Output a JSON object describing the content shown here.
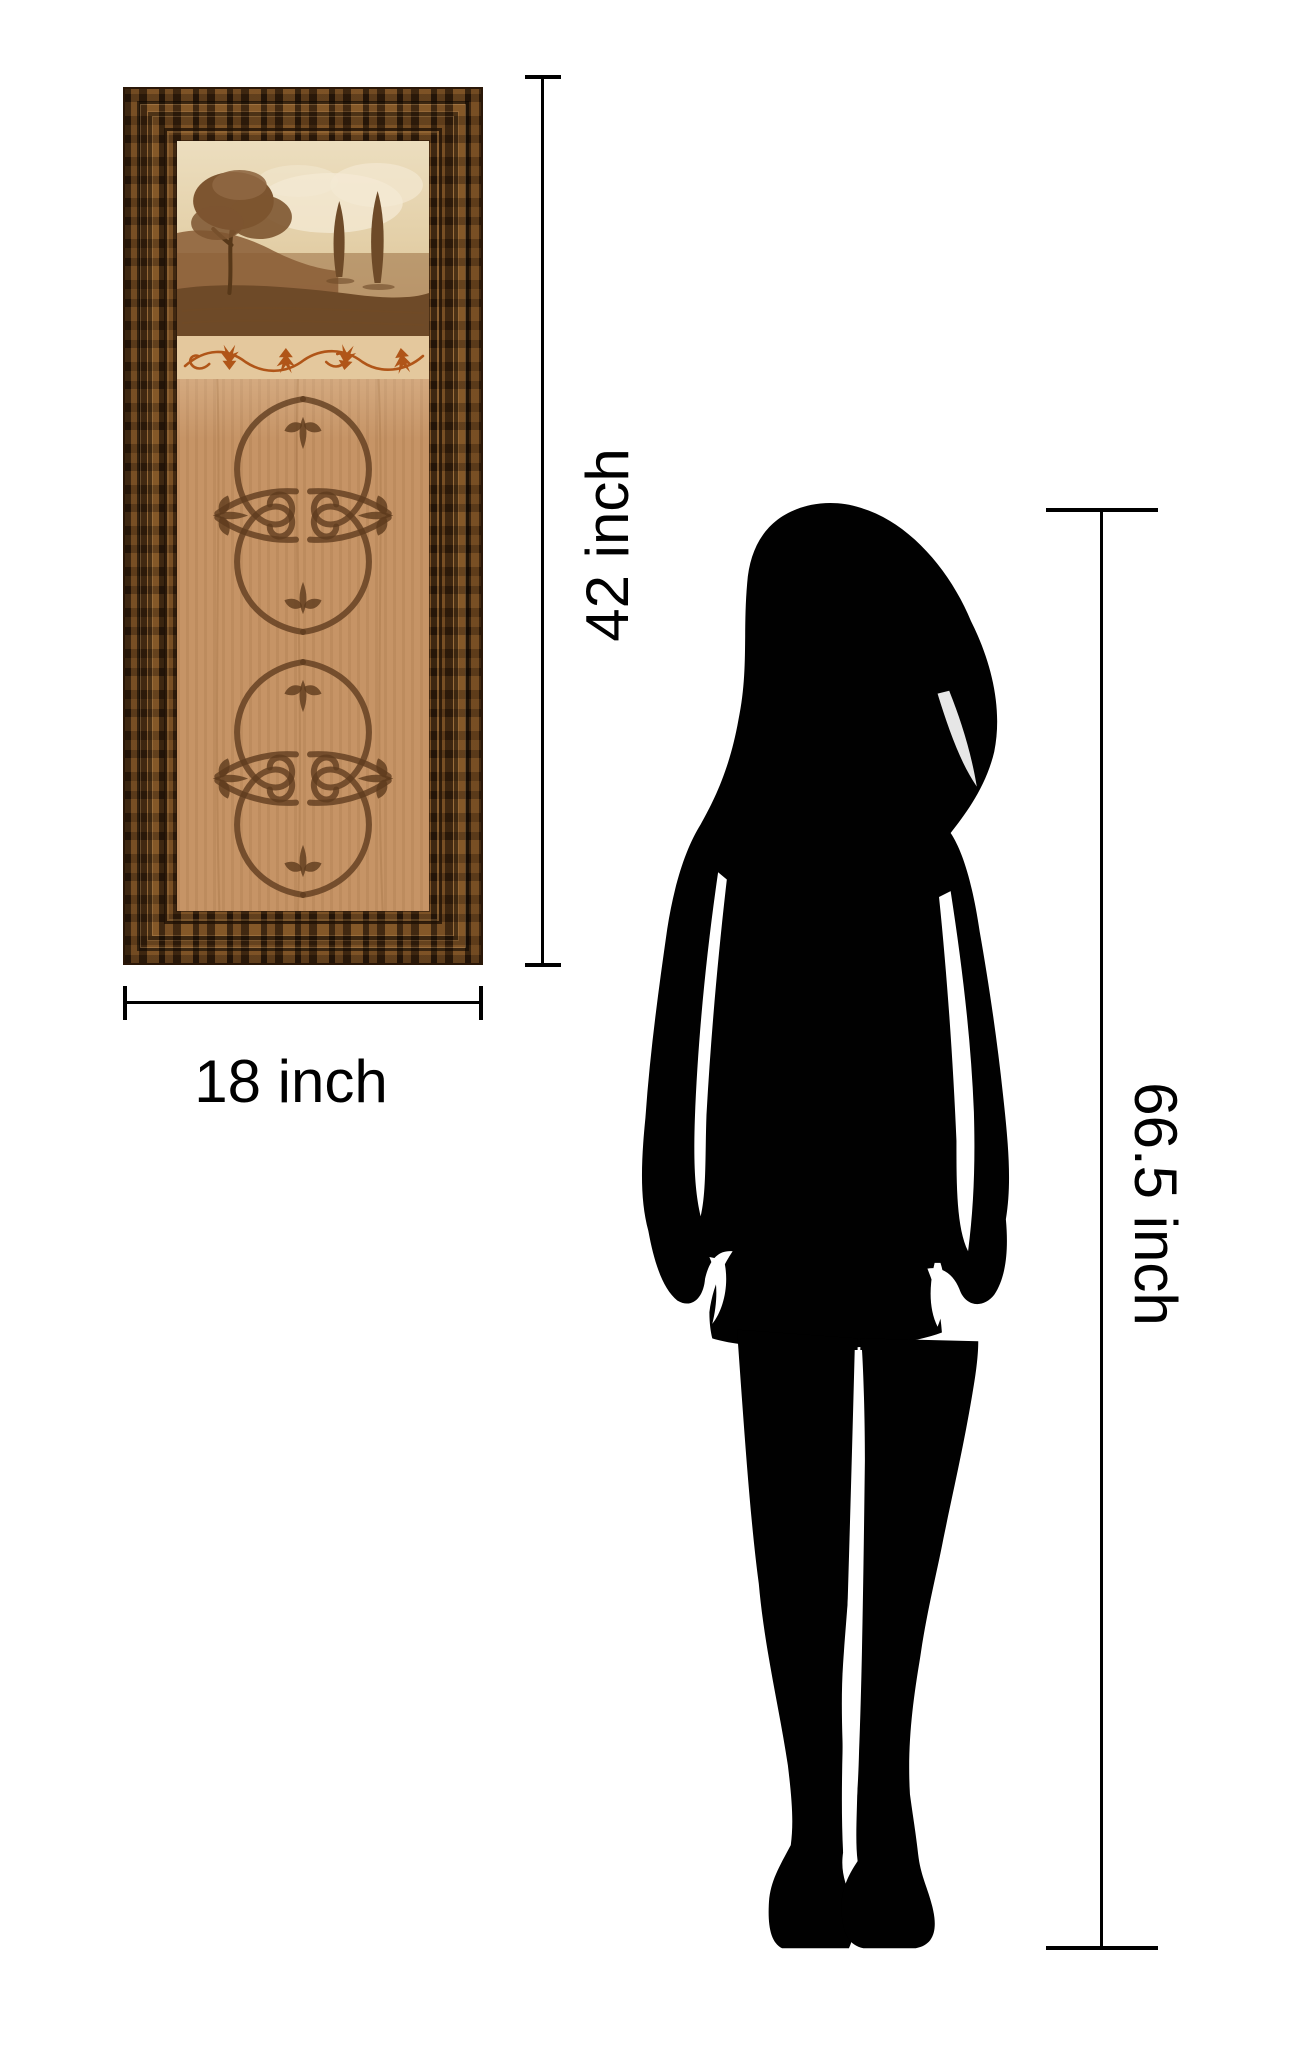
{
  "artwork": {
    "height_label": "42 inch",
    "width_label": "18 inch"
  },
  "person": {
    "height_label": "66.5 inch"
  },
  "colors": {
    "background": "#ffffff",
    "line": "#000000",
    "silhouette": "#010101",
    "frame_base": "#5d3c1c",
    "frame_dark": "#2a1708",
    "panel_wood": "#c69466",
    "band_bg": "#e4c89d",
    "leaf": "#b05518",
    "scroll": "#5e3b1d",
    "sky_light": "#ecdebf",
    "sky_warm": "#d8ba90",
    "hill": "#9b7044",
    "ground": "#6e4a28",
    "tree": "#7d5530"
  }
}
